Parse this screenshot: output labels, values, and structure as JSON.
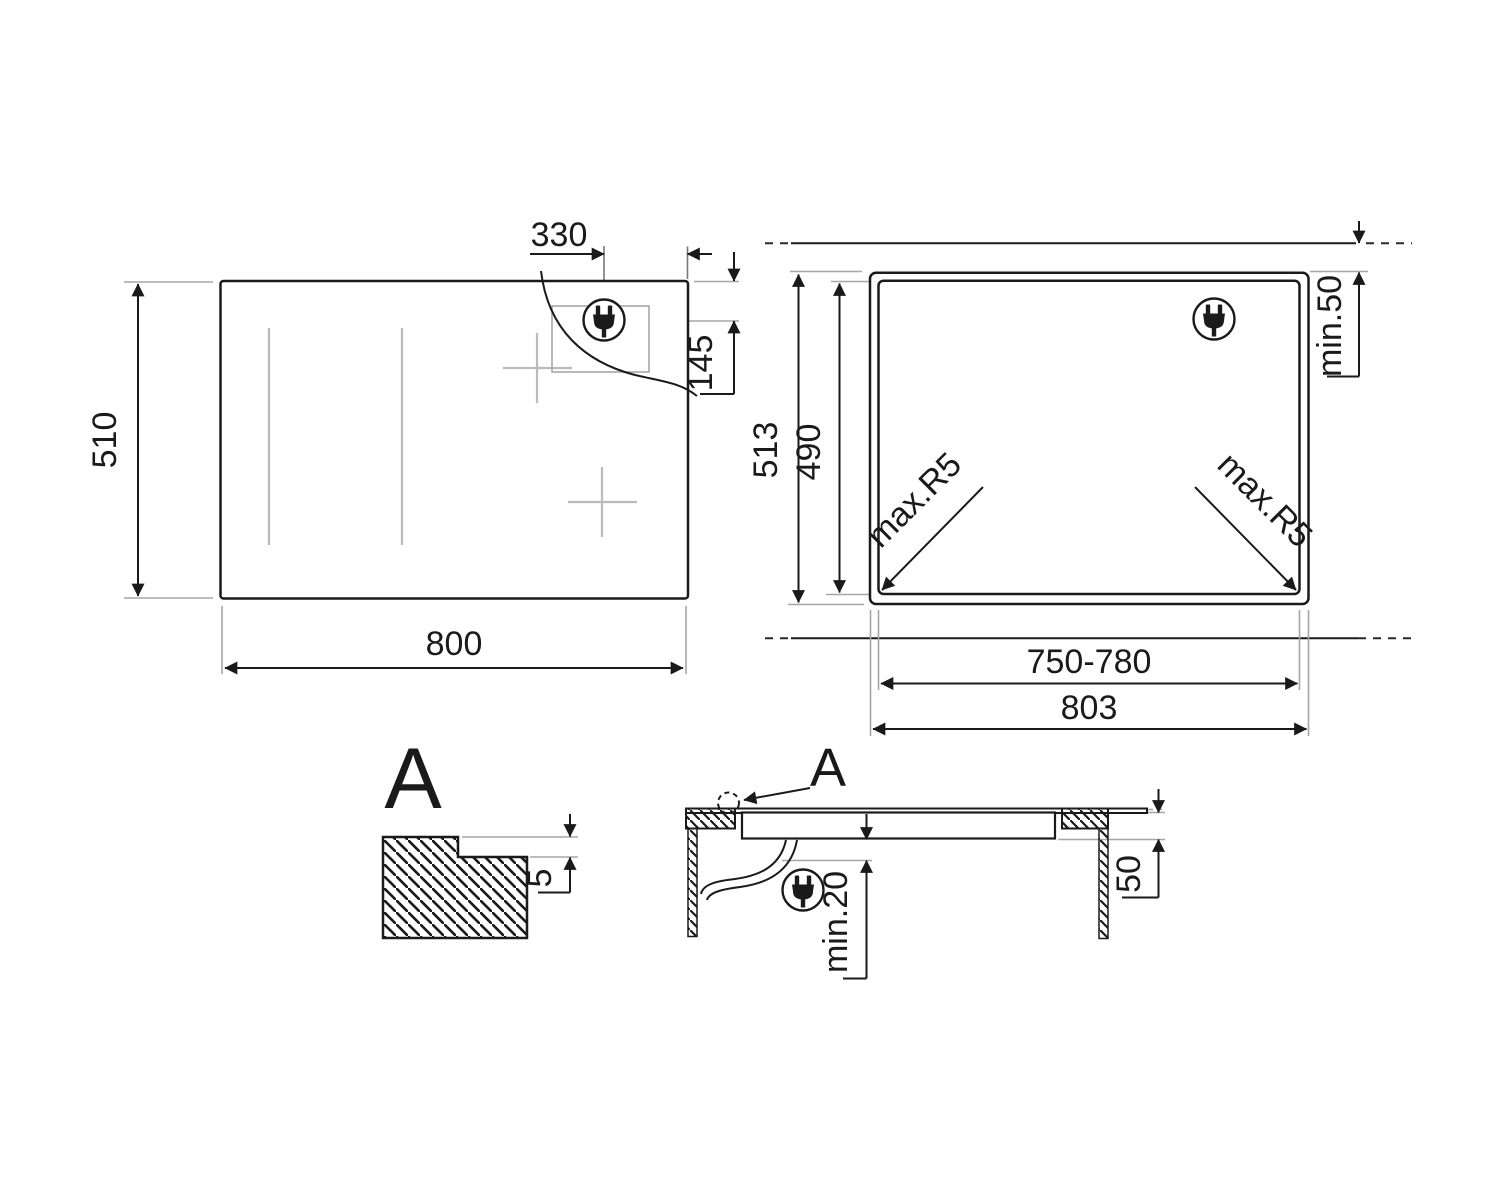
{
  "page": {
    "background": "#ffffff",
    "line_color": "#1a1a1a",
    "extension_line_color": "#a6a6a6",
    "faint_mark_color": "#bbbbbb"
  },
  "plan_view": {
    "width": "800",
    "height": "510",
    "plug_offset_x": "330",
    "plug_offset_y": "145",
    "plug_icon": "power-plug-icon"
  },
  "cutout_view": {
    "outer_height": "513",
    "inner_height": "490",
    "top_clearance": "min.50",
    "corner_radius_left": "max.R5",
    "corner_radius_right": "max.R5",
    "inner_width": "750-780",
    "outer_width": "803",
    "plug_icon": "power-plug-icon"
  },
  "detail_view": {
    "label": "A",
    "step_depth": "5"
  },
  "section_view": {
    "detail_label": "A",
    "bottom_clearance": "min.20",
    "recess_depth": "50",
    "plug_icon": "power-plug-icon"
  }
}
